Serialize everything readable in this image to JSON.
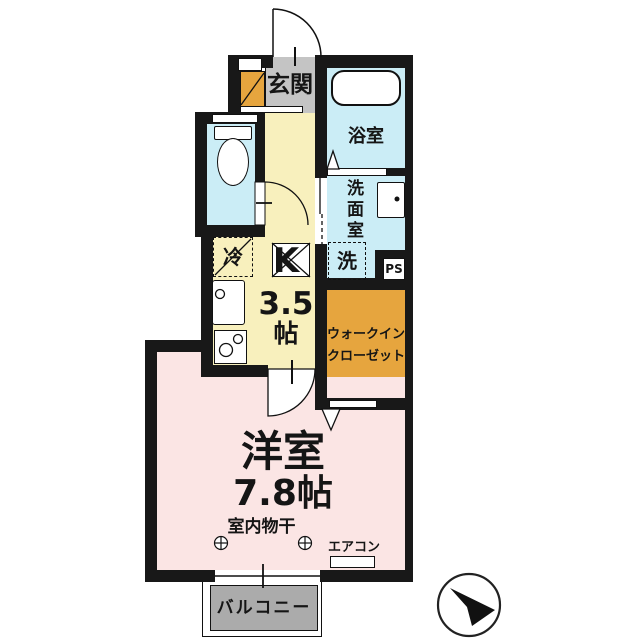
{
  "colors": {
    "wall": "#181818",
    "line": "#111111",
    "hall-yellow": "#f8f0bd",
    "entry-gray": "#c4c4c4",
    "wet-blue": "#cbedf6",
    "room-pink": "#fbe5e4",
    "closet-orange": "#e6a53e",
    "balcony-gray": "#ababab"
  },
  "floorplan": {
    "entrance": {
      "label": "玄関"
    },
    "bath": {
      "label": "浴室"
    },
    "washroom": {
      "label": "洗面室",
      "washer": "洗",
      "pipe_space": "PS"
    },
    "kitchen": {
      "label": "K",
      "size": "3.5",
      "unit": "帖",
      "fridge": "冷"
    },
    "wic": {
      "line1": "ウォークイン",
      "line2": "クローゼット"
    },
    "room": {
      "label": "洋室",
      "size": "7.8帖",
      "drying": "室内物干",
      "aircon": "エアコン"
    },
    "balcony": {
      "label": "バルコニー"
    }
  }
}
